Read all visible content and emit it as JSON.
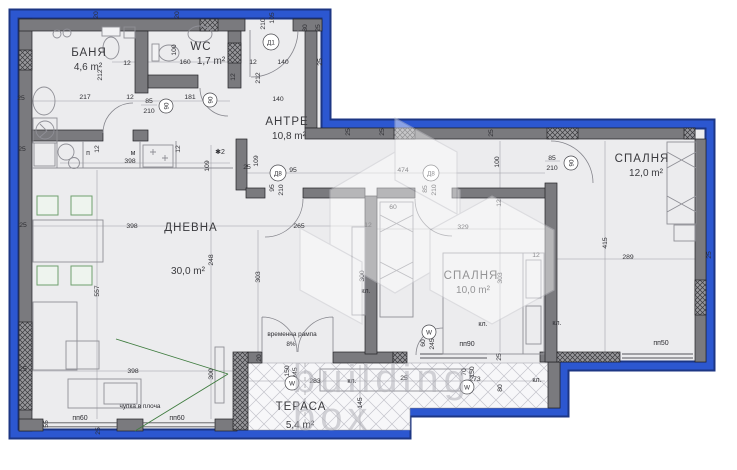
{
  "watermark": {
    "line1": "building",
    "line2": "box"
  },
  "rooms": {
    "bath": {
      "name": "БАНЯ",
      "area": "4,6 m²"
    },
    "wc": {
      "name": "WC",
      "area": "1,7 m²"
    },
    "hall": {
      "name": "АНТРЕ",
      "area": "10,8 m²"
    },
    "bedroom_large": {
      "name": "СПАЛНЯ",
      "area": "12,0 m²"
    },
    "bedroom_small": {
      "name": "СПАЛНЯ",
      "area": "10,0 m²"
    },
    "living": {
      "name": "ДНЕВНА",
      "area": "30,0 m²"
    },
    "terrace": {
      "name": "ТЕРАСА",
      "area": "5,4 m²"
    }
  },
  "notes": {
    "ramp": "временна рампа",
    "ramp_slope": "8%",
    "slab_break": "чупка в плоча"
  },
  "tags": {
    "closet": "кл.",
    "window60": "пп60",
    "window90": "пп90",
    "window50": "пп50",
    "label_p": "п",
    "label_m": "м",
    "star_note": "✱2",
    "door_d1": "Д1",
    "door_d8": "Д8",
    "door_90": "90",
    "window_w": "W"
  },
  "dims": {
    "n12": "12",
    "n20": "20",
    "n25": "25",
    "n30": "30",
    "n55": "55",
    "n60": "60",
    "n70": "70",
    "n80": "80",
    "n85": "85",
    "n95": "95",
    "n100": "100",
    "n105": "105",
    "n109": "109",
    "n140": "140",
    "n145": "145",
    "n150": "150",
    "n160": "160",
    "n181": "181",
    "n210": "210",
    "n212": "212",
    "n217": "217",
    "n245": "245",
    "n248": "248",
    "n265": "265",
    "n273": "273",
    "n283": "283",
    "n289": "289",
    "n300": "300",
    "n303": "303",
    "n329": "329",
    "n398": "398",
    "n415": "415",
    "n474": "474",
    "n557": "557"
  }
}
